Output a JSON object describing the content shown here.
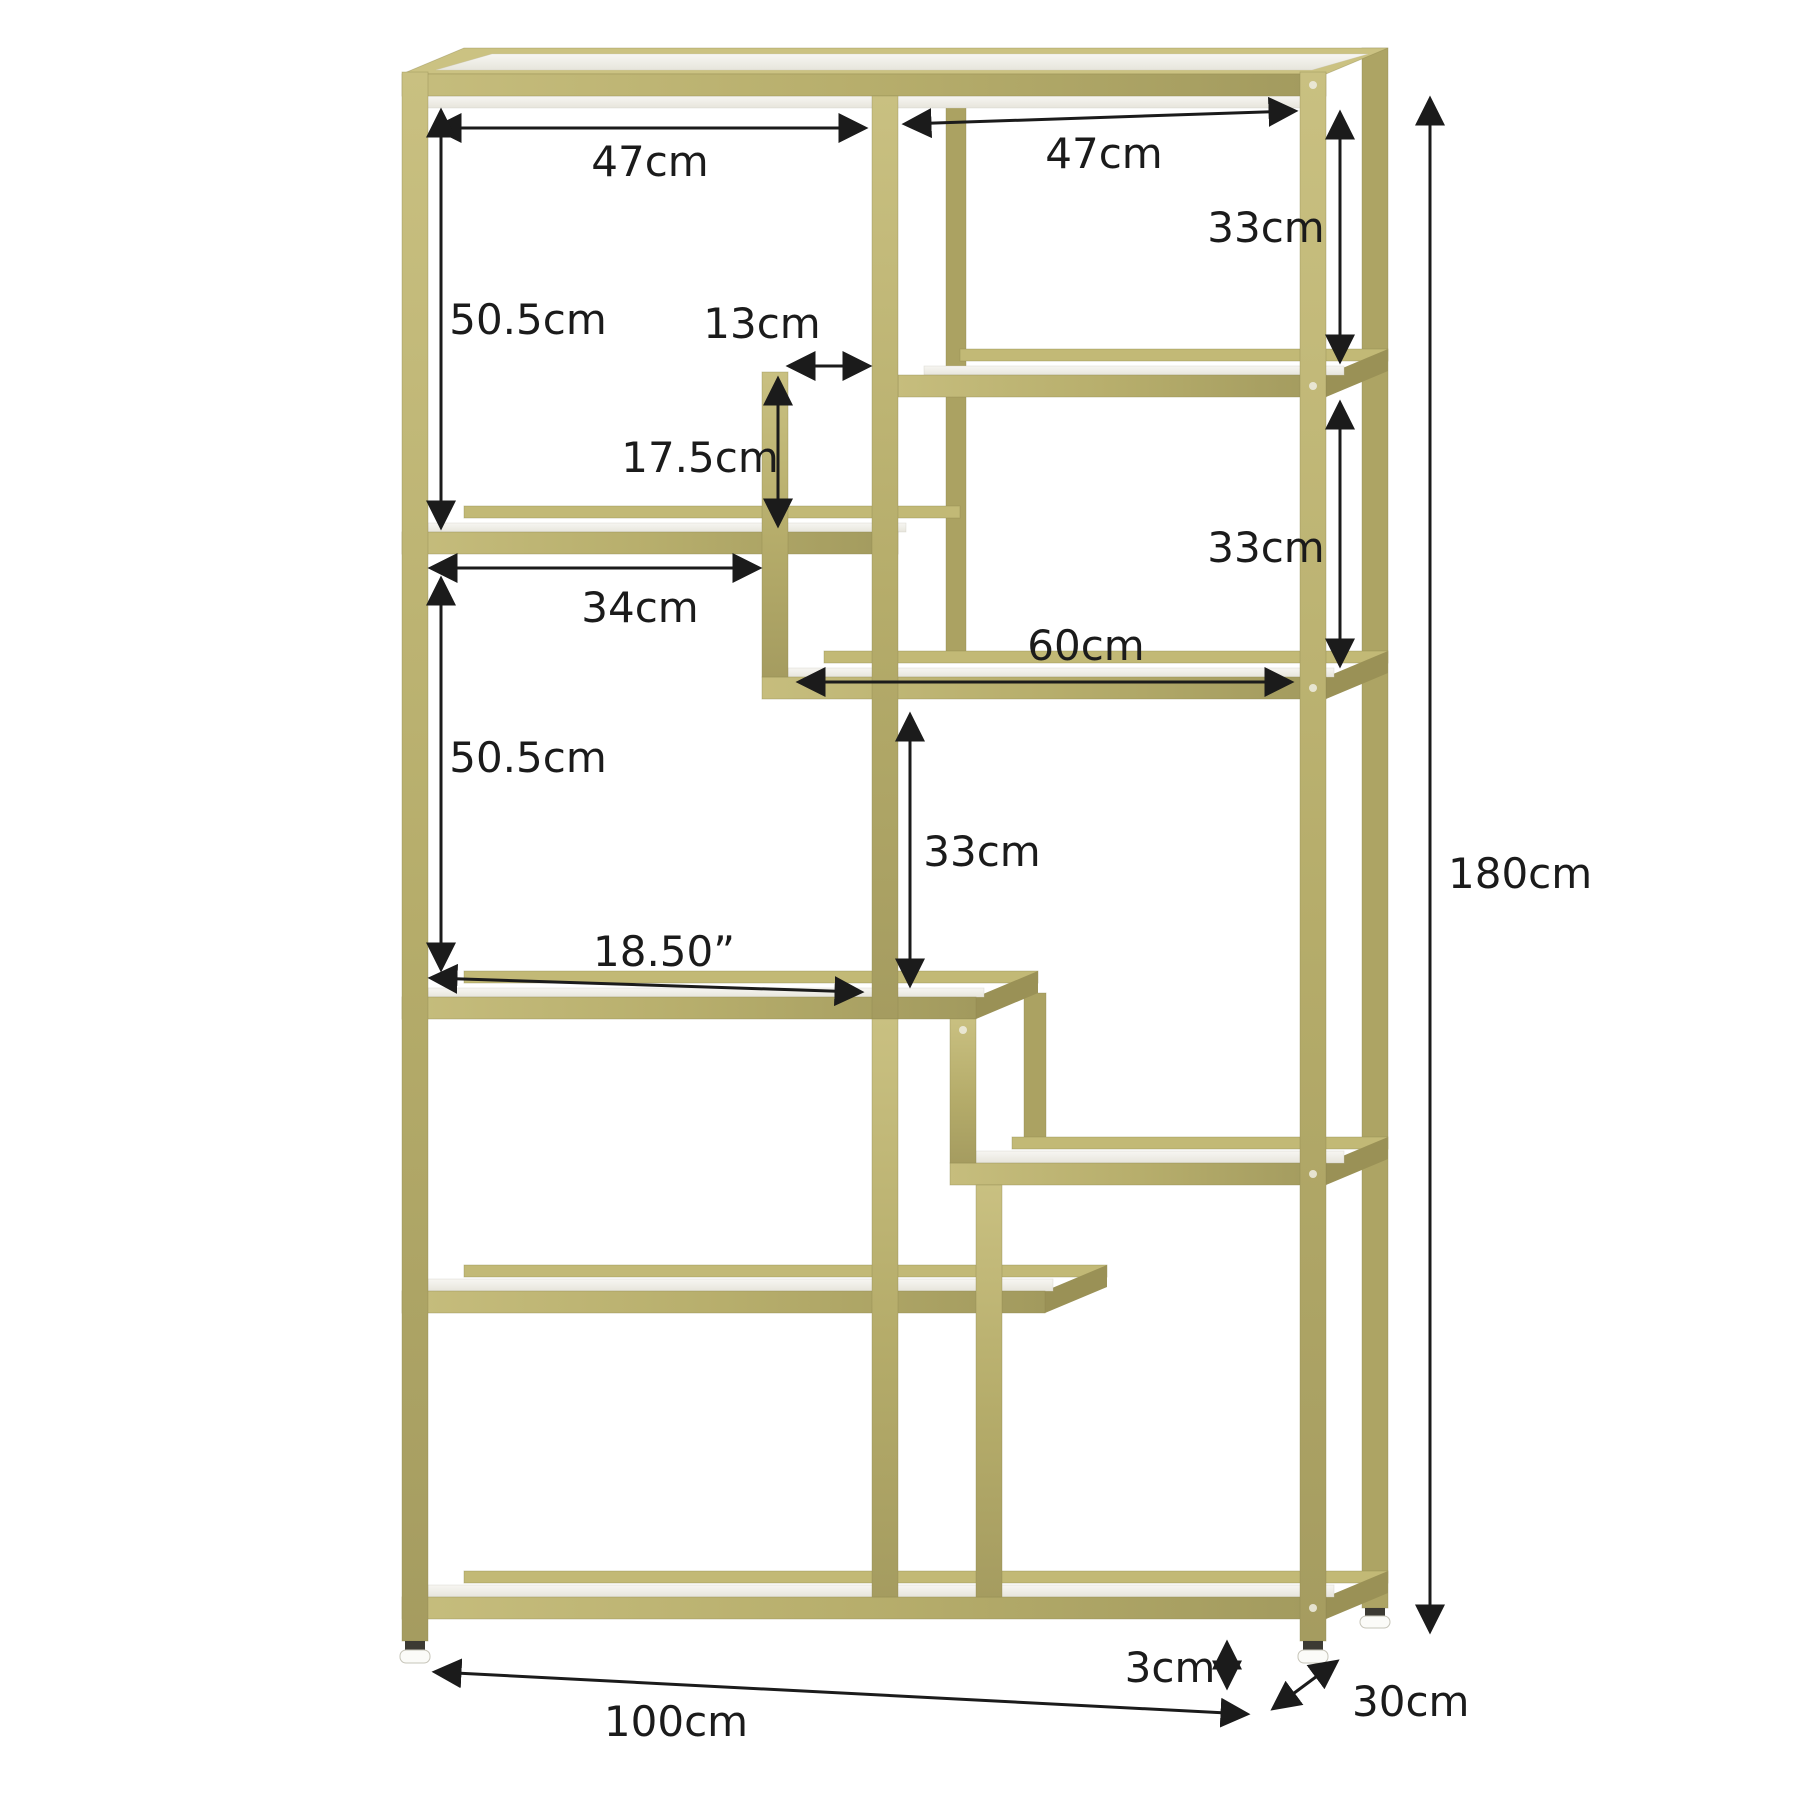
{
  "figure": {
    "kind": "product-dimension-diagram",
    "subject": "gold 8-tier staggered etagere bookshelf with faux-marble shelves",
    "background": "#ffffff"
  },
  "colors": {
    "frame_gold": "#b7ae6c",
    "frame_gold_light": "#cbc282",
    "frame_gold_dark": "#9a9156",
    "frame_gold_back": "#c2b976",
    "marble_white": "#f4f3ee",
    "marble_shade": "#e4e2d9",
    "annotation": "#1b1b1b",
    "foot_white": "#fbfbf8",
    "foot_dark": "#3c3a33"
  },
  "dims": {
    "top_left_width": "47cm",
    "top_right_width": "47cm",
    "upper_right_height": "33cm",
    "upper_left_height": "50.5cm",
    "center_gap_width": "13cm",
    "hanging_post_height": "17.5cm",
    "mid_left_width": "34cm",
    "mid_right_height": "33cm",
    "right_shelf_width": "60cm",
    "center_height": "33cm",
    "lower_left_height": "50.5cm",
    "middle_shelf_width": "18.50”",
    "overall_height": "180cm",
    "foot_height": "3cm",
    "overall_width": "100cm",
    "overall_depth": "30cm"
  }
}
